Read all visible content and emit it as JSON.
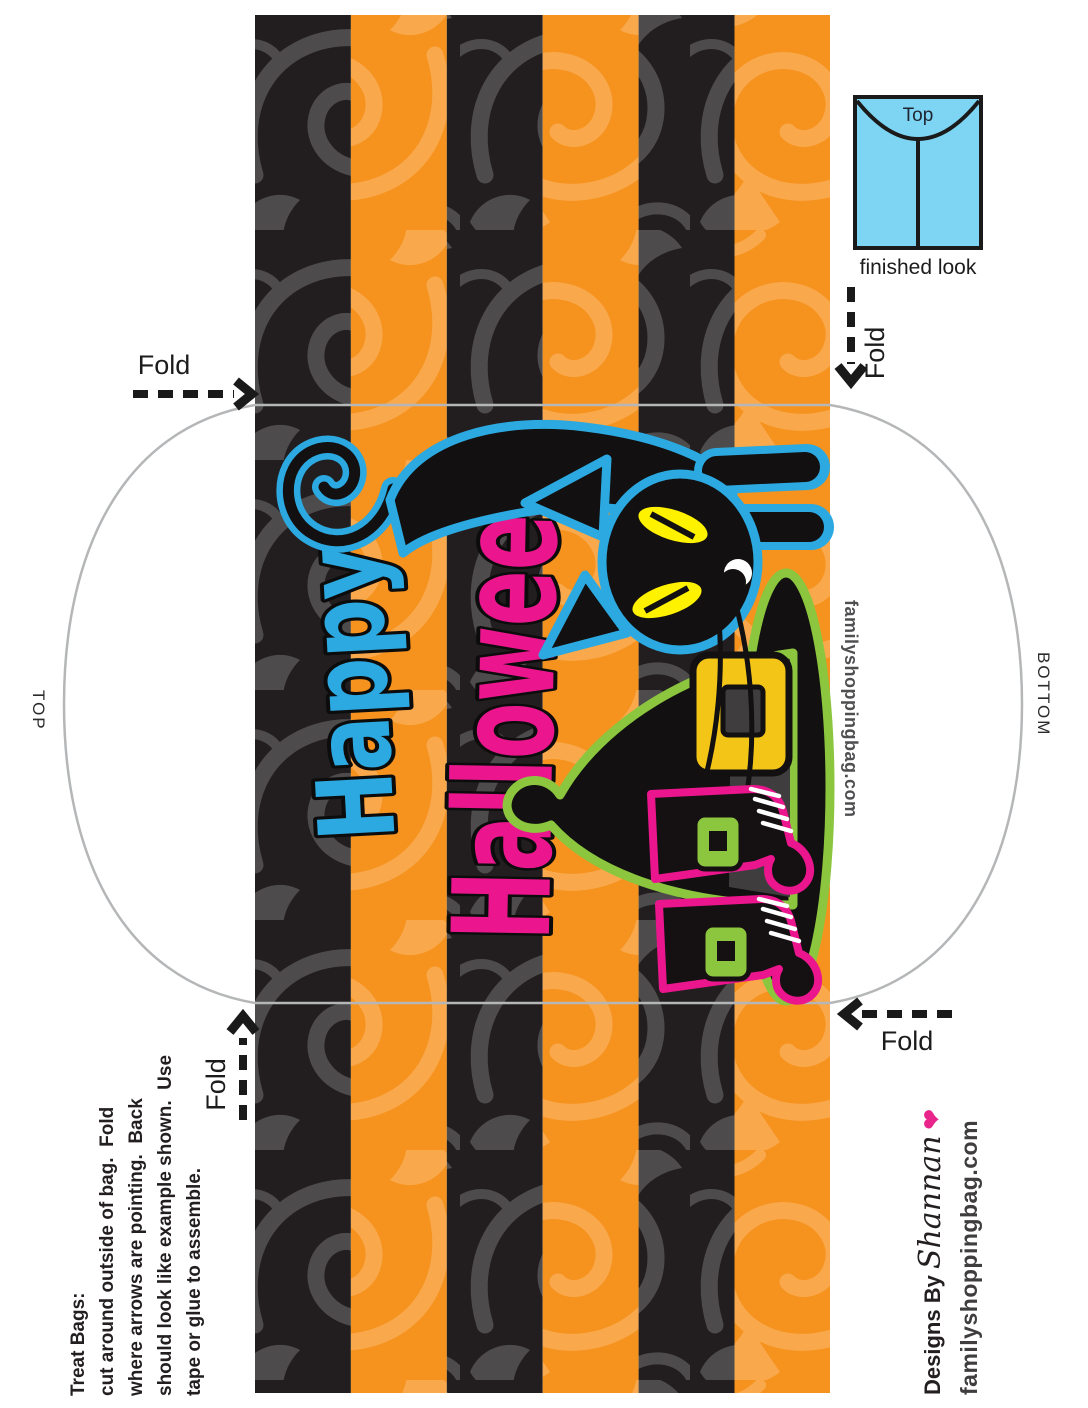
{
  "labels": {
    "fold_top_left": "Fold",
    "fold_right": "Fold",
    "fold_bottom_left": "Fold",
    "fold_bottom_right": "Fold",
    "side_top": "TOP",
    "side_bottom": "BOTTOM"
  },
  "finished_look": {
    "box_label": "Top",
    "caption": "finished look"
  },
  "artwork": {
    "word1": "Happy",
    "word2": "Halloween"
  },
  "watermark": "familyshoppingbag.com",
  "instructions": {
    "heading": "Treat Bags:",
    "line1": "cut around outside of bag.  Fold",
    "line2": "where arrows are pointing.  Back",
    "line3": "should look like example shown.  Use",
    "line4": "tape or glue to assemble."
  },
  "credits": {
    "prefix": "Designs By ",
    "designer": "Shannan",
    "heart": "❤",
    "website": "familyshoppingbag.com"
  },
  "colors": {
    "stripe_orange": "#F6921E",
    "orange_damask": "#F9A94C",
    "stripe_black": "#221E1F",
    "gray_damask": "#4D4B4C",
    "accent_blue": "#2BA9E0",
    "finished_box_blue": "#7ED4F3",
    "accent_pink": "#EB168D",
    "accent_green": "#8CC63E",
    "eye_yellow": "#FFF200",
    "buckle_gold": "#F3C517",
    "cutline_gray": "#B4B6B8"
  }
}
